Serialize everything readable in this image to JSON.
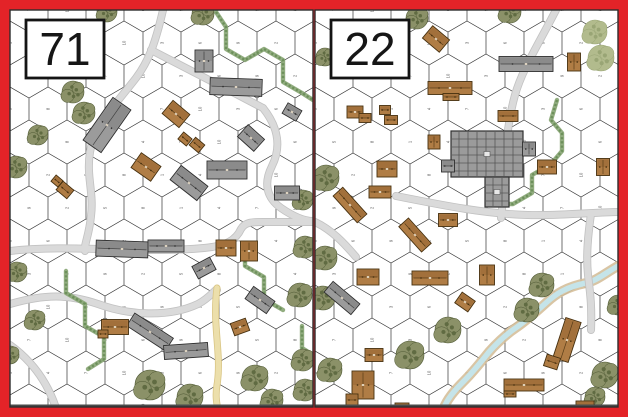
{
  "palette": {
    "border_red": "#e32328",
    "board_bg": "#ffffff",
    "board_edge": "#2d2d2d",
    "board_bottom_edge": "#4a4a4a",
    "grid_line": "#3f3f3f",
    "hex_number": "#555555",
    "road": "#dadada",
    "road_edge": "#c2c2c2",
    "dirt_road": "#ecdfab",
    "dirt_road_edge": "#d9c584",
    "hedge": "#86a472",
    "hedge_dark": "#6d905b",
    "tree": "#8b9168",
    "tree_dark": "#606b42",
    "tree_edge": "#4e5833",
    "orchard": "#b2bb8d",
    "orchard_dark": "#99a575",
    "stone_building": "#9b9b9b",
    "stone_dark": "#6e6e6e",
    "stone_edge": "#2f2f2f",
    "wood_building": "#b07d45",
    "wood_dark": "#8a5a28",
    "wood_edge": "#46300f",
    "stream_water": "#c5e4e9",
    "stream_bank": "#d5bf9a",
    "label_box_bg": "#ffffff",
    "label_box_border": "#141414",
    "label_text": "#161616"
  },
  "grid": {
    "hex_width": 38,
    "hex_side": 22,
    "row_height": 33,
    "number_font_size": 4.2
  },
  "boards": [
    {
      "label": "71",
      "x": 10,
      "y": 10,
      "w": 303,
      "h": 397,
      "label_box": {
        "x": 26,
        "y": 20,
        "w": 78,
        "h": 58,
        "font_size": 46
      },
      "roads": [
        {
          "d": "M163,10 C155,45 148,62 136,78 C116,104 94,126 90,152 C86,176 94,192 91,216 C89,236 84,244 85,251"
        },
        {
          "d": "M151,50 C185,68 225,88 263,108"
        },
        {
          "d": "M263,108 C279,128 281,148 272,166 C263,184 267,198 281,208 C294,217 305,221 313,221"
        },
        {
          "d": "M10,251 C70,244 140,254 204,248 C226,246 236,240 241,229 C245,222 252,222 263,222 L313,222"
        },
        {
          "d": "M10,304 C45,294 68,294 98,304 C128,315 168,318 198,304 C211,297 216,288 217,290"
        },
        {
          "d": "M10,345 C28,358 46,378 56,408"
        }
      ],
      "dirt_roads": [
        {
          "d": "M217,288 C212,325 222,355 217,385 C215,397 217,404 218,410"
        }
      ],
      "streams": [],
      "hedges": [
        {
          "d": "M216,12 L226,27 L226,49 L245,60 L264,49 L283,60 L283,82 L302,93 L313,100"
        },
        {
          "d": "M245,244 L245,266 L264,277 L264,299 L283,310"
        },
        {
          "d": "M66,271 L66,293 L85,304 L85,326 L104,337 L104,359 L88,369"
        },
        {
          "d": "M302,326 L302,348 L313,355"
        }
      ],
      "trees": [
        [
          107,
          12,
          10
        ],
        [
          203,
          14,
          11
        ],
        [
          73,
          92,
          11
        ],
        [
          84,
          113,
          11
        ],
        [
          38,
          135,
          10
        ],
        [
          16,
          167,
          11
        ],
        [
          17,
          272,
          10
        ],
        [
          35,
          320,
          10
        ],
        [
          10,
          355,
          9
        ],
        [
          150,
          385,
          15
        ],
        [
          190,
          397,
          13
        ],
        [
          255,
          378,
          13
        ],
        [
          272,
          400,
          11
        ],
        [
          303,
          360,
          11
        ],
        [
          305,
          390,
          11
        ],
        [
          300,
          295,
          12
        ],
        [
          305,
          247,
          11
        ],
        [
          303,
          200,
          10
        ]
      ],
      "orchards": [],
      "buildings": [
        [
          204,
          61,
          18,
          22,
          0,
          "s"
        ],
        [
          236,
          87,
          52,
          17,
          2,
          "s"
        ],
        [
          107,
          125,
          22,
          52,
          35,
          "s"
        ],
        [
          251,
          138,
          22,
          16,
          42,
          "s"
        ],
        [
          189,
          183,
          34,
          18,
          38,
          "s"
        ],
        [
          227,
          170,
          40,
          18,
          0,
          "s"
        ],
        [
          287,
          193,
          25,
          14,
          0,
          "s"
        ],
        [
          292,
          112,
          16,
          12,
          30,
          "s"
        ],
        [
          122,
          249,
          52,
          16,
          2,
          "s"
        ],
        [
          166,
          246,
          36,
          12,
          0,
          "s"
        ],
        [
          150,
          332,
          46,
          15,
          33,
          "s"
        ],
        [
          186,
          351,
          44,
          14,
          -4,
          "s"
        ],
        [
          204,
          268,
          20,
          14,
          -28,
          "s"
        ],
        [
          260,
          300,
          26,
          15,
          35,
          "s"
        ],
        [
          176,
          114,
          22,
          17,
          40,
          "w"
        ],
        [
          185,
          139,
          11,
          9,
          40,
          "w"
        ],
        [
          197,
          145,
          12,
          10,
          40,
          "w"
        ],
        [
          146,
          167,
          24,
          18,
          35,
          "w"
        ],
        [
          65,
          190,
          14,
          11,
          40,
          "w"
        ],
        [
          57,
          181,
          9,
          8,
          40,
          "w"
        ],
        [
          226,
          248,
          20,
          16,
          0,
          "w"
        ],
        [
          249,
          251,
          17,
          20,
          0,
          "w"
        ],
        [
          240,
          327,
          16,
          13,
          -20,
          "w"
        ],
        [
          115,
          327,
          27,
          15,
          0,
          "w"
        ],
        [
          103,
          334,
          10,
          8,
          0,
          "w"
        ]
      ]
    },
    {
      "label": "22",
      "x": 315,
      "y": 10,
      "w": 303,
      "h": 397,
      "label_box": {
        "x": 331,
        "y": 20,
        "w": 78,
        "h": 58,
        "font_size": 46
      },
      "roads": [
        {
          "d": "M556,10 C538,45 522,70 515,95 C508,120 505,150 504,180 C503,200 502,210 501,218"
        },
        {
          "d": "M315,222 C332,230 344,243 356,257"
        },
        {
          "d": "M396,196 C446,206 487,214 528,215 C560,216 598,212 618,212"
        },
        {
          "d": "M591,214 C588,235 586,255 588,275 C590,292 592,305 591,330"
        }
      ],
      "dirt_roads": [],
      "streams": [
        {
          "d": "M618,266 C604,274 596,281 586,283 C566,287 556,294 547,302 C536,312 527,320 517,327 C505,335 497,343 489,352 C481,362 473,372 464,381 C454,391 447,399 443,410"
        }
      ],
      "hedges": [
        {
          "d": "M557,100 L551,120 L562,133 L562,151 L551,164 L532,175 L532,193 L513,204 L494,204"
        }
      ],
      "trees": [
        [
          417,
          18,
          11
        ],
        [
          510,
          12,
          11
        ],
        [
          325,
          57,
          9
        ],
        [
          326,
          178,
          13
        ],
        [
          325,
          258,
          12
        ],
        [
          323,
          298,
          12
        ],
        [
          448,
          330,
          13
        ],
        [
          410,
          355,
          14
        ],
        [
          330,
          370,
          12
        ],
        [
          542,
          285,
          12
        ],
        [
          527,
          310,
          12
        ],
        [
          618,
          305,
          10
        ],
        [
          605,
          375,
          13
        ],
        [
          595,
          397,
          10
        ]
      ],
      "orchards": [
        [
          595,
          32,
          12
        ],
        [
          601,
          58,
          13
        ]
      ],
      "buildings": [
        [
          526,
          64,
          54,
          15,
          0,
          "s"
        ],
        [
          342,
          298,
          35,
          14,
          40,
          "s"
        ],
        [
          487,
          154,
          72,
          46,
          0,
          "f"
        ],
        [
          497,
          192,
          24,
          30,
          0,
          "f"
        ],
        [
          448,
          166,
          13,
          12,
          0,
          "s"
        ],
        [
          529,
          149,
          13,
          14,
          0,
          "s"
        ],
        [
          436,
          39,
          22,
          16,
          40,
          "w"
        ],
        [
          450,
          88,
          44,
          13,
          0,
          "w"
        ],
        [
          451,
          97,
          16,
          7,
          0,
          "w"
        ],
        [
          355,
          112,
          16,
          12,
          0,
          "w"
        ],
        [
          365,
          118,
          12,
          9,
          0,
          "w"
        ],
        [
          385,
          110,
          11,
          9,
          0,
          "w"
        ],
        [
          391,
          120,
          13,
          9,
          0,
          "w"
        ],
        [
          434,
          142,
          12,
          14,
          0,
          "w"
        ],
        [
          387,
          169,
          20,
          16,
          0,
          "w"
        ],
        [
          380,
          192,
          22,
          12,
          0,
          "w"
        ],
        [
          350,
          205,
          36,
          13,
          48,
          "w"
        ],
        [
          508,
          116,
          20,
          11,
          0,
          "w"
        ],
        [
          547,
          167,
          19,
          14,
          0,
          "w"
        ],
        [
          603,
          167,
          13,
          17,
          0,
          "w"
        ],
        [
          448,
          220,
          19,
          13,
          0,
          "w"
        ],
        [
          415,
          235,
          34,
          13,
          48,
          "w"
        ],
        [
          368,
          277,
          22,
          16,
          0,
          "w"
        ],
        [
          430,
          278,
          36,
          14,
          0,
          "w"
        ],
        [
          574,
          62,
          13,
          18,
          0,
          "w"
        ],
        [
          487,
          275,
          15,
          20,
          0,
          "w"
        ],
        [
          567,
          340,
          16,
          42,
          18,
          "w"
        ],
        [
          552,
          362,
          14,
          12,
          18,
          "w"
        ],
        [
          524,
          385,
          40,
          12,
          0,
          "w"
        ],
        [
          510,
          394,
          12,
          6,
          0,
          "w"
        ],
        [
          585,
          406,
          18,
          10,
          0,
          "w"
        ],
        [
          363,
          385,
          22,
          28,
          0,
          "w"
        ],
        [
          352,
          400,
          12,
          12,
          0,
          "w"
        ],
        [
          374,
          355,
          18,
          13,
          0,
          "w"
        ],
        [
          402,
          407,
          14,
          8,
          0,
          "w"
        ],
        [
          465,
          302,
          16,
          13,
          35,
          "w"
        ]
      ]
    }
  ]
}
